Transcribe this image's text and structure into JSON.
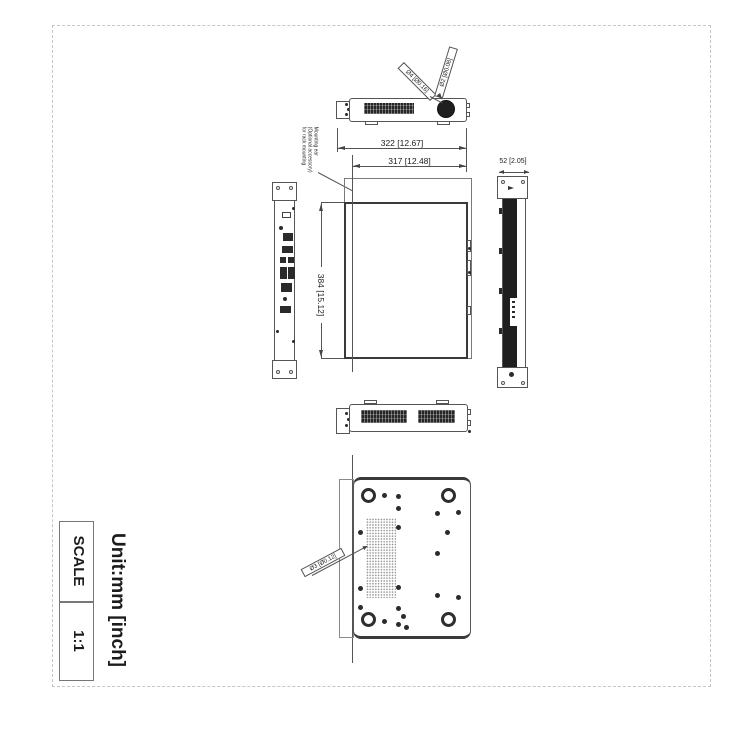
{
  "page": {
    "unit_label": "Unit:mm [inch]",
    "scale": {
      "label": "SCALE",
      "value": "1:1"
    }
  },
  "dimensions": {
    "width_outer": "322 [12.67]",
    "width_body": "317 [12.48]",
    "depth": "384 [15.12]",
    "height": "52 [2.05]"
  },
  "callouts": {
    "hole_small": "Ø2 [Ø0.08]",
    "hole_large": "Ø4 [Ø0.16]",
    "hole_bottom": "Ø3 [Ø0.12]"
  },
  "notes": {
    "mounting_ear_line1": "Mounting ear",
    "mounting_ear_line2": "(Optional accessory)",
    "mounting_ear_line3": "for rack mounting"
  },
  "colors": {
    "line": "#4a4a4a",
    "bold_line": "#333333",
    "dark_fill": "#1f1f1f",
    "dash_border": "#c6c6c6"
  }
}
